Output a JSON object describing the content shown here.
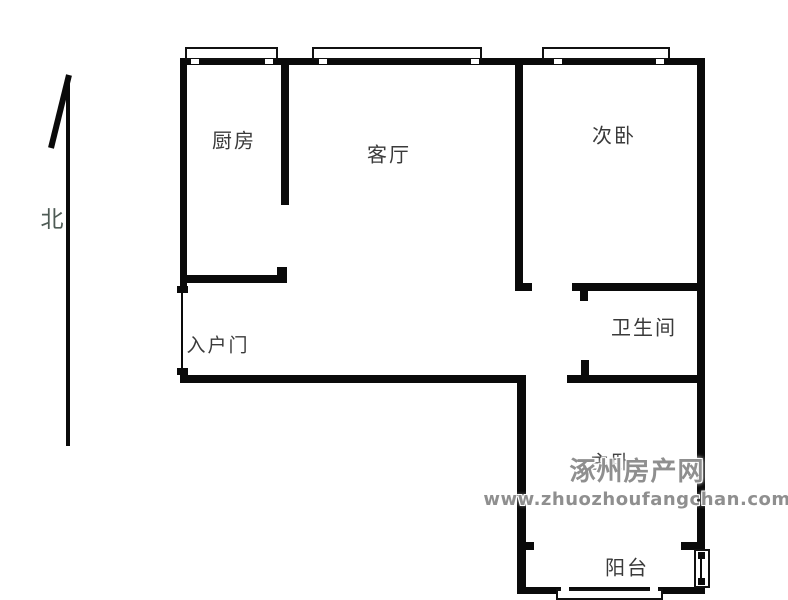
{
  "floorplan": {
    "rooms": {
      "kitchen": "厨房",
      "living_room": "客厅",
      "secondary_bedroom": "次卧",
      "entry_door": "入户门",
      "bathroom": "卫生间",
      "master_bedroom": "主卧",
      "balcony": "阳台"
    },
    "compass": {
      "north_label": "北"
    },
    "watermark": {
      "site_name": "涿州房产网",
      "site_url": "www.zhuozhoufangchan.com"
    },
    "colors": {
      "background": "#ffffff",
      "wall": "#0a0a0a",
      "room_text": "#3a3a3a",
      "compass_text": "#4e5b55",
      "watermark_text": "#8f8f8f"
    }
  }
}
